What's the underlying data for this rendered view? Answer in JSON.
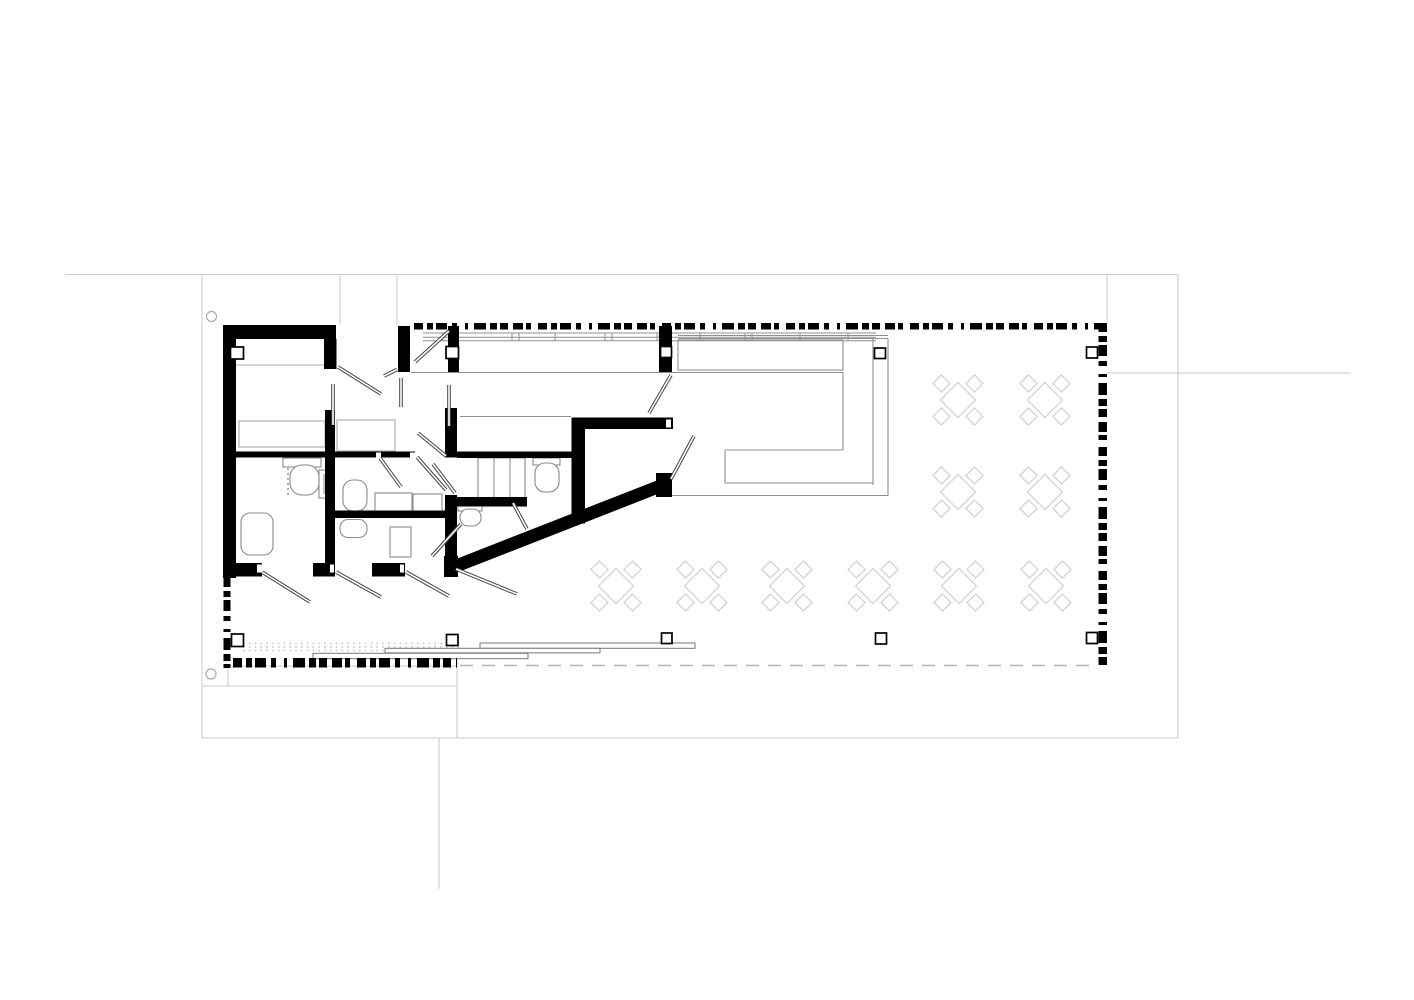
{
  "canvas": {
    "width": 1414,
    "height": 1000,
    "background": "#ffffff"
  },
  "drawing": {
    "type": "architectural-floor-plan",
    "colors": {
      "wall": "#000000",
      "frame_line": "#c9c9c9",
      "ref_line": "#b0b0b0",
      "counter_line": "#8f8f8f",
      "fixture_line": "#8a8a8a",
      "furniture_line": "#a8a8a8",
      "table_line": "#cfcfcf",
      "door_line": "#444444",
      "dash_line": "#b5b5b5",
      "dot_line": "#c4c4c4",
      "white": "#ffffff"
    },
    "frame_lines": [
      [
        65,
        274.5,
        1178,
        274.5
      ],
      [
        202,
        274.5,
        202,
        738
      ],
      [
        1178,
        274.5,
        1178,
        738
      ],
      [
        202,
        738,
        1178,
        738
      ],
      [
        203,
        686,
        457,
        686
      ],
      [
        457,
        660,
        457,
        738
      ],
      [
        439,
        738,
        439,
        889
      ],
      [
        1107,
        373,
        1351,
        373
      ],
      [
        1107,
        274.5,
        1107,
        322
      ],
      [
        340,
        276,
        340,
        324
      ],
      [
        397,
        276,
        397,
        324
      ]
    ],
    "frame_rects": [
      [
        228,
        666,
        229,
        20
      ]
    ],
    "circles": [
      {
        "cx": 211.5,
        "cy": 316.5,
        "r": 5
      },
      {
        "cx": 211.0,
        "cy": 674.0,
        "r": 5
      }
    ],
    "counter_lines": [
      [
        411,
        372.5,
        843,
        372.5
      ],
      [
        678,
        335.5,
        888,
        335.5
      ],
      [
        678,
        338.5,
        888,
        338.5
      ],
      [
        843,
        372.5,
        843,
        450
      ],
      [
        873,
        338.5,
        873,
        485
      ],
      [
        888,
        338.5,
        888,
        495.5
      ],
      [
        725,
        450,
        843,
        450
      ],
      [
        725,
        450,
        725,
        483
      ],
      [
        725,
        483,
        873,
        483
      ],
      [
        672,
        495.5,
        888,
        495.5
      ],
      [
        460,
        416.5,
        571,
        416.5
      ]
    ],
    "counter_rects": [
      [
        678,
        340,
        165,
        30
      ]
    ],
    "bench": {
      "x1": 423,
      "x2": 876,
      "line_ys": [
        333,
        337.3,
        340.7
      ],
      "tick_xs": [
        443,
        512,
        519,
        555,
        605,
        612,
        657,
        700,
        745,
        752,
        800,
        848
      ]
    },
    "dot_rows": {
      "x1": 243,
      "x2": 460,
      "ys": [
        643.5,
        647,
        650.5
      ]
    },
    "dashed_line": [
      460,
      665.5,
      1097,
      665.5
    ],
    "sliding_panels": [
      [
        480,
        643.0,
        215,
        5.3
      ],
      [
        385,
        648.3,
        215,
        4.6
      ],
      [
        313,
        653.3,
        215,
        5.4
      ]
    ],
    "checker_seq": [
      9,
      4,
      6,
      3,
      11,
      5,
      5,
      8,
      3,
      6,
      12,
      4,
      7,
      3,
      8,
      5,
      10,
      3,
      5,
      7
    ],
    "checker_bands": [
      {
        "x": 414,
        "y": 323,
        "length": 693,
        "thickness": 6.5,
        "dir": "h"
      },
      {
        "x": 1098.5,
        "y": 323,
        "length": 345,
        "thickness": 8.5,
        "dir": "v"
      },
      {
        "x": 233,
        "y": 658,
        "length": 224,
        "thickness": 9.5,
        "dir": "h"
      },
      {
        "x": 223.5,
        "y": 578,
        "length": 90,
        "thickness": 7.0,
        "dir": "v"
      }
    ],
    "walls": [
      [
        223,
        325,
        113,
        14
      ],
      [
        223,
        325,
        13,
        253
      ],
      [
        324,
        339,
        12.5,
        30
      ],
      [
        398,
        326,
        12,
        46
      ],
      [
        448,
        326,
        11,
        46
      ],
      [
        659,
        326,
        13,
        46
      ],
      [
        325,
        410,
        10,
        156
      ],
      [
        223,
        451.5,
        192,
        6
      ],
      [
        457,
        451.5,
        116,
        6.5
      ],
      [
        445,
        408,
        12,
        49.5
      ],
      [
        445,
        495,
        12,
        68
      ],
      [
        325,
        510.5,
        120,
        7.5
      ],
      [
        445,
        497,
        82,
        9.5
      ],
      [
        573,
        417.5,
        100,
        11.5
      ],
      [
        571.5,
        417.5,
        13.5,
        106
      ],
      [
        656,
        473,
        16,
        24
      ],
      [
        444,
        556,
        14,
        21
      ],
      [
        228,
        563,
        34,
        13.5
      ],
      [
        313,
        563,
        22,
        13.5
      ],
      [
        372,
        563,
        33,
        13.5
      ]
    ],
    "diagonal_wall": {
      "x1": 663,
      "y1": 485,
      "x2": 456,
      "y2": 566,
      "thickness": 13
    },
    "wall_notches": [
      [
        257,
        564.5,
        5,
        8
      ],
      [
        330,
        564.5,
        4,
        8
      ],
      [
        400,
        564.5,
        4,
        8
      ],
      [
        666,
        419.5,
        5,
        8
      ],
      [
        376,
        452.5,
        5,
        5
      ],
      [
        410,
        452.5,
        5,
        5
      ]
    ],
    "columns": [
      [
        230.5,
        347,
        13,
        12
      ],
      [
        446,
        346.5,
        12.5,
        12
      ],
      [
        660.5,
        346.5,
        11,
        11
      ],
      [
        874.5,
        348,
        11,
        10.5
      ],
      [
        1086.5,
        347,
        11,
        11
      ],
      [
        231.5,
        634,
        12,
        12.5
      ],
      [
        446.5,
        634.5,
        11.5,
        11
      ],
      [
        661.5,
        633,
        10.5,
        10.5
      ],
      [
        875.5,
        633,
        11,
        11
      ],
      [
        1086.5,
        632.5,
        11,
        11
      ]
    ],
    "door_leaves": [
      [
        338,
        367,
        381,
        394
      ],
      [
        384,
        376,
        397,
        369.5
      ],
      [
        415,
        362,
        449,
        331
      ],
      [
        333,
        384,
        333,
        425
      ],
      [
        401,
        378,
        401,
        407
      ],
      [
        449,
        385,
        449,
        426
      ],
      [
        380,
        458,
        401,
        487
      ],
      [
        417,
        457,
        446,
        490
      ],
      [
        418,
        433,
        446,
        456
      ],
      [
        433,
        464,
        455,
        493
      ],
      [
        513,
        503,
        527,
        529
      ],
      [
        671,
        375,
        649,
        413
      ],
      [
        694,
        436,
        671,
        479
      ],
      [
        262,
        572,
        310,
        602
      ],
      [
        336,
        572,
        381,
        597
      ],
      [
        406,
        572,
        449,
        596
      ],
      [
        456,
        569,
        517,
        594
      ],
      [
        432,
        556,
        461,
        524
      ]
    ],
    "fixture_rects": [
      [
        283,
        458,
        38,
        9
      ],
      [
        319,
        470,
        10,
        28
      ],
      [
        375,
        493,
        37,
        20
      ],
      [
        413,
        494,
        29,
        19
      ],
      [
        390,
        527,
        21,
        30
      ],
      [
        478,
        458,
        47,
        40
      ],
      [
        533,
        458,
        27,
        7
      ],
      [
        458,
        505,
        24,
        6
      ]
    ],
    "furniture_rects": [
      [
        239,
        421,
        86,
        26
      ],
      [
        337,
        420,
        58,
        31
      ]
    ],
    "fixture_round_rects": [
      [
        290,
        465,
        29,
        30,
        12
      ],
      [
        343,
        480,
        24,
        31,
        10
      ],
      [
        535,
        463,
        24,
        29,
        10
      ],
      [
        460,
        509,
        21,
        17,
        8
      ],
      [
        241,
        513,
        32,
        42,
        9
      ],
      [
        340,
        519.5,
        27,
        18,
        8
      ]
    ],
    "fixture_lines": [
      [
        494,
        458,
        494,
        498
      ],
      [
        510,
        458,
        510,
        498
      ],
      [
        324,
        474,
        324,
        494
      ]
    ],
    "furniture_lines": [
      [
        236,
        365,
        325,
        365
      ]
    ],
    "dotted_lines": [
      [
        288,
        468,
        288,
        497
      ]
    ],
    "tables": {
      "centers": [
        [
          958,
          400
        ],
        [
          1045,
          400
        ],
        [
          958,
          492
        ],
        [
          1045,
          492
        ],
        [
          616,
          586
        ],
        [
          702,
          586
        ],
        [
          787,
          586
        ],
        [
          873,
          586
        ],
        [
          959,
          586
        ],
        [
          1046,
          586
        ]
      ],
      "table_half": 17.5,
      "chair_half": 8.5,
      "chair_offset": 16.5
    }
  }
}
